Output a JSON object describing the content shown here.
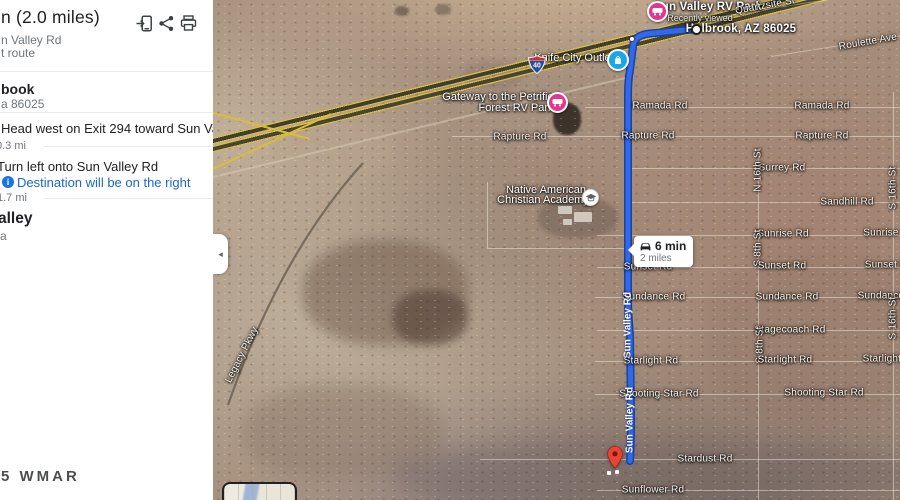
{
  "sidebar": {
    "title": "n (2.0 miles)",
    "via": "n Valley Rd",
    "route_type": "t route",
    "destination": {
      "name": "book",
      "detail": "a 86025"
    },
    "steps": [
      {
        "instruction": "Head west on Exit 294 toward Sun Valley Rd",
        "distance": "0.3 mi"
      },
      {
        "instruction": "Turn left onto Sun Valley Rd",
        "note": "Destination will be on the right",
        "note_icon": "i",
        "distance": "1.7 mi"
      }
    ],
    "arrival": {
      "name": "alley",
      "detail": "a"
    },
    "watermark": "5 WMAR",
    "icons": [
      "send-to-phone-icon",
      "share-icon",
      "print-icon"
    ]
  },
  "map": {
    "tooltip": {
      "duration": "6 min",
      "distance": "2 miles"
    },
    "interstate_badge": "40",
    "collapse_arrow": "◂",
    "colors": {
      "route": "#3568e8",
      "route_border": "#16459e",
      "poi_pink": "#e3368f",
      "poi_blue": "#18a7e8",
      "destination_red": "#ea4335",
      "highway_yellow": "#d9be37",
      "link_blue": "#1967d2"
    },
    "labels": [
      {
        "text": "Sun Valley RV Park",
        "cls": "poi-bold",
        "x": 495,
        "y": 7,
        "name": "poi-label-sun-valley-rv-park",
        "inter": true
      },
      {
        "text": "Recently viewed",
        "cls": "poi-sub",
        "x": 487,
        "y": 18,
        "name": "recently-viewed-label",
        "inter": false
      },
      {
        "text": "Holbrook, AZ 86025",
        "cls": "poi-bold",
        "x": 528,
        "y": 29,
        "name": "start-waypoint-label",
        "inter": true
      },
      {
        "text": "Quartzsite St",
        "cls": "road",
        "x": 552,
        "y": 6,
        "rot": -10
      },
      {
        "text": "Roulette Ave",
        "cls": "road",
        "x": 655,
        "y": 42,
        "rot": -10
      },
      {
        "text": "Knife City Outlet",
        "cls": "poi",
        "x": 361,
        "y": 58,
        "name": "poi-label-knife-city-outlet",
        "inter": true
      },
      {
        "text": "Gateway to the Petrified",
        "cls": "poi",
        "x": 288,
        "y": 97,
        "name": "poi-label-gateway-rv-park-line1",
        "inter": true
      },
      {
        "text": "Forest RV Park",
        "cls": "poi",
        "x": 303,
        "y": 108,
        "name": "poi-label-gateway-rv-park-line2",
        "inter": true
      },
      {
        "text": "Ramada Rd",
        "cls": "road",
        "x": 447,
        "y": 106
      },
      {
        "text": "Ramada Rd",
        "cls": "road",
        "x": 609,
        "y": 106
      },
      {
        "text": "Rapture Rd",
        "cls": "road",
        "x": 307,
        "y": 137
      },
      {
        "text": "Rapture Rd",
        "cls": "road",
        "x": 435,
        "y": 136
      },
      {
        "text": "Rapture Rd",
        "cls": "road",
        "x": 609,
        "y": 136
      },
      {
        "text": "Surrey Rd",
        "cls": "road",
        "x": 569,
        "y": 168
      },
      {
        "text": "N 16th St",
        "cls": "road",
        "x": 545,
        "y": 170,
        "rot": -90
      },
      {
        "text": "Sandhill Rd",
        "cls": "road",
        "x": 634,
        "y": 202
      },
      {
        "text": "S 16th St",
        "cls": "road",
        "x": 680,
        "y": 188,
        "rot": -90
      },
      {
        "text": "Native American",
        "cls": "poi",
        "x": 333,
        "y": 190,
        "name": "poi-label-academy-line1",
        "inter": true
      },
      {
        "text": "Christian Academy",
        "cls": "poi",
        "x": 330,
        "y": 200,
        "name": "poi-label-academy-line2",
        "inter": true
      },
      {
        "text": "Sunrise Rd",
        "cls": "road",
        "x": 570,
        "y": 234
      },
      {
        "text": "Sunrise Rd",
        "cls": "road",
        "x": 676,
        "y": 233
      },
      {
        "text": "S 8th St",
        "cls": "road",
        "x": 545,
        "y": 248,
        "rot": -90
      },
      {
        "text": "Sunset Rd",
        "cls": "road",
        "x": 435,
        "y": 267
      },
      {
        "text": "Sunset Rd",
        "cls": "road",
        "x": 569,
        "y": 266
      },
      {
        "text": "Sunset Rd",
        "cls": "road",
        "x": 676,
        "y": 265
      },
      {
        "text": "Sundance Rd",
        "cls": "road",
        "x": 441,
        "y": 297
      },
      {
        "text": "Sundance Rd",
        "cls": "road",
        "x": 574,
        "y": 297
      },
      {
        "text": "Sundance Rd",
        "cls": "road",
        "x": 676,
        "y": 296
      },
      {
        "text": "S 16th St",
        "cls": "road",
        "x": 680,
        "y": 318,
        "rot": -90
      },
      {
        "text": "Stagecoach Rd",
        "cls": "road",
        "x": 577,
        "y": 330
      },
      {
        "text": "S 8th St",
        "cls": "road",
        "x": 547,
        "y": 345,
        "rot": -90
      },
      {
        "text": "Sun Valley Rd",
        "cls": "on-route",
        "x": 415,
        "y": 325,
        "rot": -90
      },
      {
        "text": "Starlight Rd",
        "cls": "road",
        "x": 438,
        "y": 361
      },
      {
        "text": "Starlight Rd",
        "cls": "road",
        "x": 572,
        "y": 360
      },
      {
        "text": "Starlight Rd",
        "cls": "road",
        "x": 677,
        "y": 359
      },
      {
        "text": "Shooting Star Rd",
        "cls": "road",
        "x": 446,
        "y": 394
      },
      {
        "text": "Shooting Star Rd",
        "cls": "road",
        "x": 611,
        "y": 393
      },
      {
        "text": "Sun Valley Rd",
        "cls": "on-route",
        "x": 417,
        "y": 420,
        "rot": -90
      },
      {
        "text": "Stardust Rd",
        "cls": "road",
        "x": 492,
        "y": 459
      },
      {
        "text": "Sunflower Rd",
        "cls": "road",
        "x": 440,
        "y": 490
      },
      {
        "text": "Legacy Pkwy",
        "cls": "road",
        "x": 29,
        "y": 355,
        "rot": -63
      }
    ]
  }
}
